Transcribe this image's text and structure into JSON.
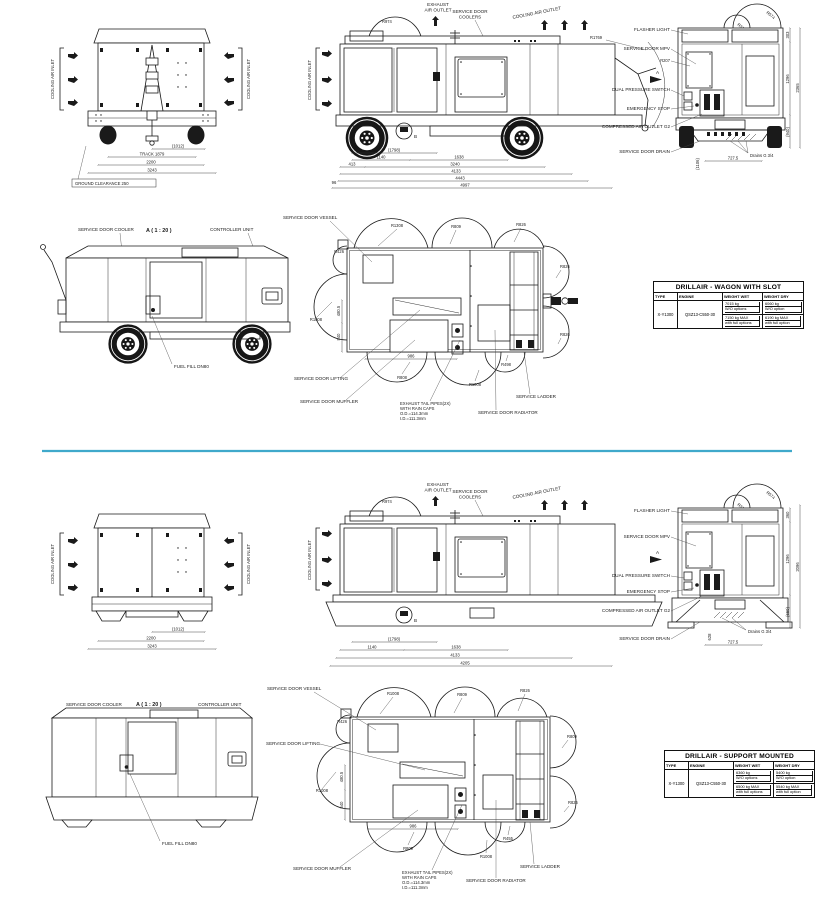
{
  "page": {
    "divider_color": "#3fa9cb"
  },
  "shared": {
    "cooling_air_inlet": "COOLING AIR INLET",
    "exhaust_l1": "EXHAUST",
    "exhaust_l2": "AIR OUTLET",
    "coolers_l1": "SERVICE DOOR",
    "coolers_l2": "COOLERS",
    "cooling_air_outlet": "COOLING AIR OUTLET",
    "flasher": "FLASHER LIGHT",
    "mpv": "SERVICE DOOR MPV",
    "dual": "DUAL PRESSURE SWITCH",
    "estop": "EMERGENCY STOP",
    "outlet_g2": "COMPRESSED AIR OUTLET G2",
    "drain_door": "SERVICE DOOR DRAIN",
    "drains": "Drains G 3/4",
    "a_marker": "A",
    "b_marker": "B",
    "detail_title": "A ( 1 : 20 )",
    "cooler_door": "SERVICE DOOR COOLER",
    "controller": "CONTROLLER UNIT",
    "fuel": "FUEL FILL DN80",
    "vessel": "SERVICE DOOR VESSEL",
    "lifting": "SERVICE DOOR LIFTING",
    "muffler": "SERVICE DOOR MUFFLER",
    "radiator": "SERVICE DOOR RADIATOR",
    "ladder": "SERVICE LADDER",
    "exh1": "EXHAUST TAIL PIPES(2X)",
    "exh2": "WITH RAIN CAPS",
    "exh3": "O.D.=114.3mm",
    "exh4": "I.D.=111.3mm",
    "r974": "R974",
    "r314": "R314",
    "r574": "R574",
    "r207": "R207",
    "r1769": "R1769"
  },
  "sheet1": {
    "front": {
      "d1": "(1012)",
      "d2": "TRACK 1879",
      "d3": "2200",
      "d4": "3243",
      "ground": "GROUND CLEARANCE 250"
    },
    "side": {
      "d1": "(1798)",
      "d2": "1140",
      "d3": "1638",
      "d4": "413",
      "d5": "3240",
      "d6": "4133",
      "d7": "4443",
      "d8": "4997",
      "d9": "96"
    },
    "rear": {
      "h1": "303",
      "h2": "1296",
      "h3": "2365",
      "h4": "(940)",
      "w1": "727.5",
      "v1": "(1106)"
    },
    "plan": {
      "r1": "R1308",
      "r2": "R809",
      "r3": "R826",
      "r4": "R826",
      "r5": "R1008",
      "r6": "R808",
      "r7": "R1008",
      "r8": "R498",
      "r9": "R826",
      "r10": "R426",
      "v1": "480.5",
      "v2": "540",
      "w1": "986"
    },
    "table": {
      "title": "DRILLAIR - WAGON WITH SLOT",
      "headers": [
        "TYPE",
        "ENGINE",
        "WEIGHT WET",
        "WEIGHT DRY"
      ],
      "type": "X-Y1300",
      "engine": "QSZ13-C550-30",
      "wet_a1": "7015 kg",
      "wet_a2": "W/O options",
      "wet_b1": "7150 kg MAX",
      "wet_b2": "with full options",
      "dry_a1": "6060 kg",
      "dry_a2": "W/O option",
      "dry_b1": "6190 kg MAX",
      "dry_b2": "with full option"
    }
  },
  "sheet2": {
    "front": {
      "d1": "(1012)",
      "d3": "2200",
      "d4": "3243"
    },
    "side": {
      "d1": "(1798)",
      "d2": "1140",
      "d3": "1638",
      "d6": "4133",
      "d8": "4205"
    },
    "rear": {
      "h1": "360",
      "h2": "1296",
      "h3": "2096",
      "h4": "(650)",
      "w1": "727.5",
      "v1": "628"
    },
    "plan": {
      "r1": "R1008",
      "r2": "R809",
      "r3": "R826",
      "r4": "R809",
      "r5": "R1008",
      "r6": "R809",
      "r7": "R1008",
      "r8": "R455",
      "r9": "R826",
      "r10": "R426",
      "v1": "480.5",
      "v2": "540",
      "w1": "986"
    },
    "table": {
      "title": "DRILLAIR - SUPPORT MOUNTED",
      "headers": [
        "TYPE",
        "ENGINE",
        "WEIGHT WET",
        "WEIGHT DRY"
      ],
      "type": "X-Y1300",
      "engine": "QSZ13-C550-30",
      "wet_a1": "6360 kg",
      "wet_a2": "W/O options",
      "wet_b1": "6500 kg MAX",
      "wet_b2": "with full options",
      "dry_a1": "5400 kg",
      "dry_a2": "W/O option",
      "dry_b1": "5540 kg MAX",
      "dry_b2": "with full option"
    }
  }
}
